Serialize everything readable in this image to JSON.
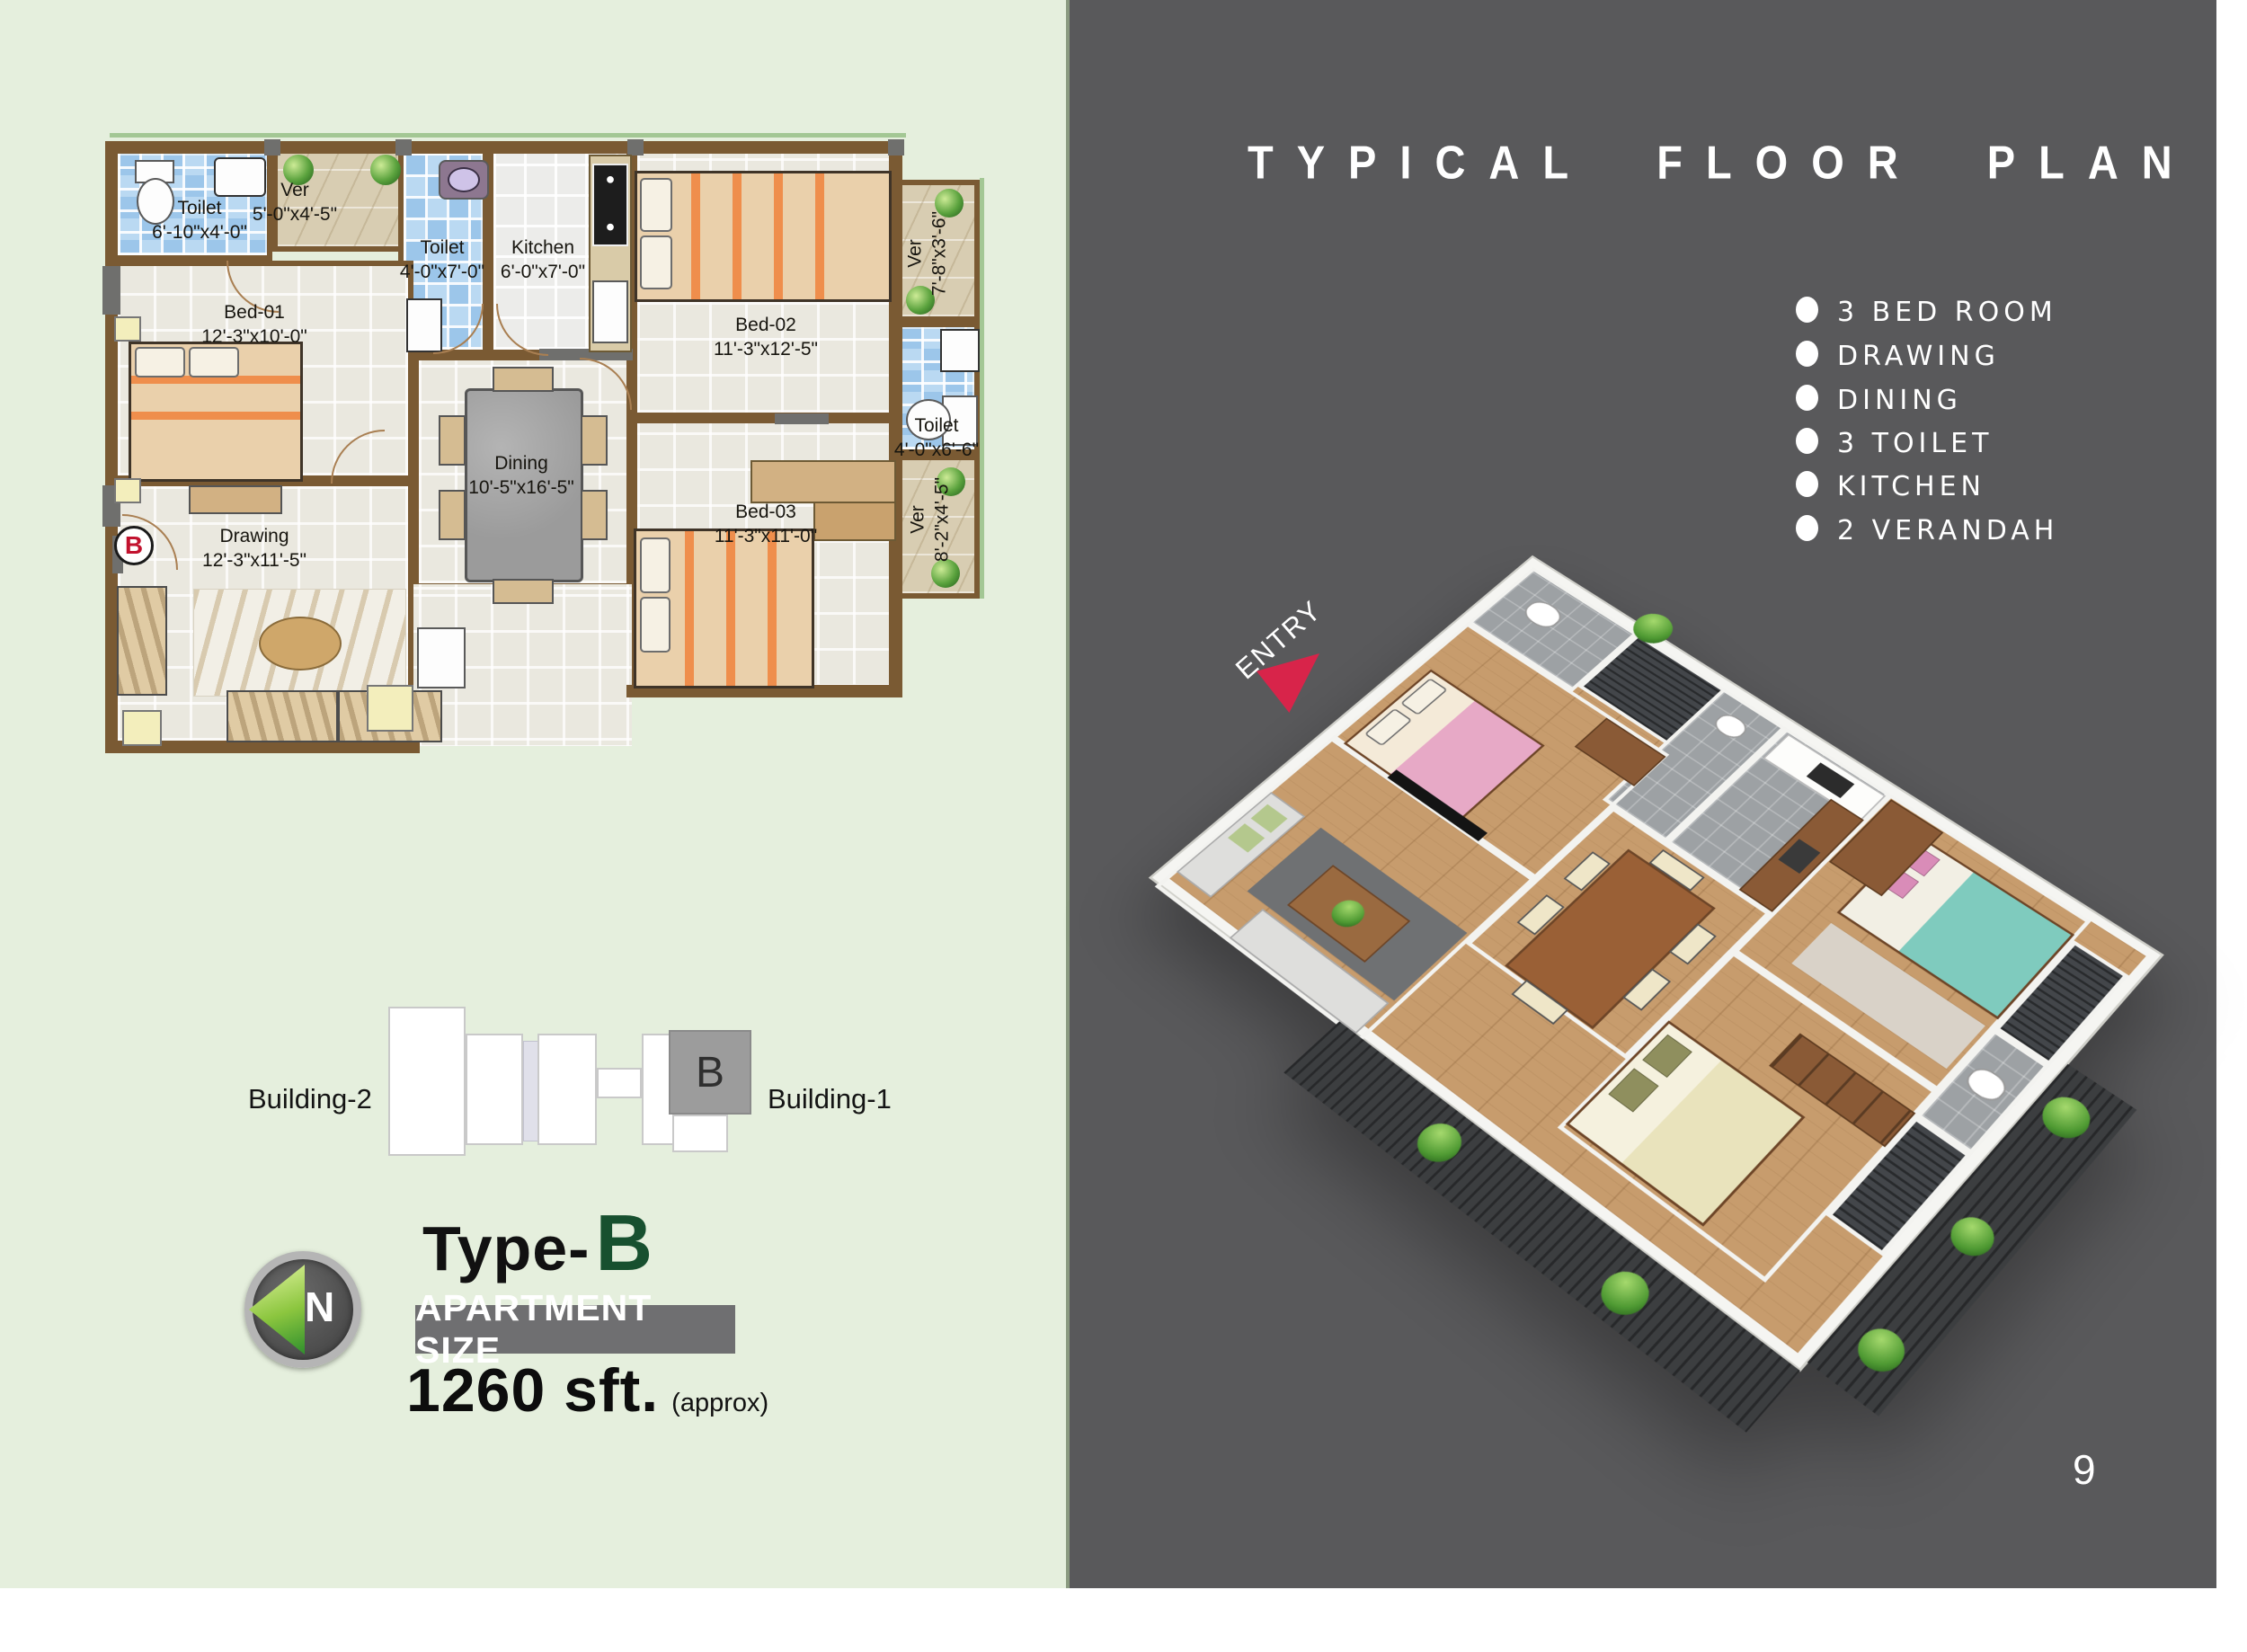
{
  "title": "TYPICAL FLOOR PLAN",
  "features": [
    "3 BED ROOM",
    "DRAWING",
    "DINING",
    "3 TOILET",
    "KITCHEN",
    "2 VERANDAH"
  ],
  "entry_label": "ENTRY",
  "page_number": "9",
  "plan2d": {
    "marker_letter": "B",
    "rooms": [
      {
        "name": "Toilet",
        "dims": "6'-10\"x4'-0\""
      },
      {
        "name": "Ver",
        "dims": "5'-0\"x4'-5\""
      },
      {
        "name": "Toilet",
        "dims": "4'-0\"x7'-0\""
      },
      {
        "name": "Kitchen",
        "dims": "6'-0\"x7'-0\""
      },
      {
        "name": "Bed-02",
        "dims": "11'-3\"x12'-5\""
      },
      {
        "name": "Ver",
        "dims": "7'-8\"x3'-6\""
      },
      {
        "name": "Toilet",
        "dims": "4'-0\"x6'-6\""
      },
      {
        "name": "Bed-01",
        "dims": "12'-3\"x10'-0\""
      },
      {
        "name": "Dining",
        "dims": "10'-5\"x16'-5\""
      },
      {
        "name": "Bed-03",
        "dims": "11'-3\"x11'-0\""
      },
      {
        "name": "Ver",
        "dims": "8'-2\"x4'-5\""
      },
      {
        "name": "Drawing",
        "dims": "12'-3\"x11'-5\""
      }
    ]
  },
  "key_diagram": {
    "building_left": "Building-2",
    "building_right": "Building-1",
    "unit_letter": "B"
  },
  "type_block": {
    "prefix": "Type-",
    "letter": "B",
    "banner": "APARTMENT SIZE",
    "size_value": "1260 sft.",
    "size_approx": "(approx)"
  },
  "compass": {
    "letter": "N"
  },
  "colors": {
    "panel_green": "#e5efdd",
    "panel_gray": "#59595b",
    "wall_brown": "#7a5a33",
    "type_green": "#17502f",
    "marker_red": "#c2122e",
    "entry_red": "#d8244a"
  }
}
